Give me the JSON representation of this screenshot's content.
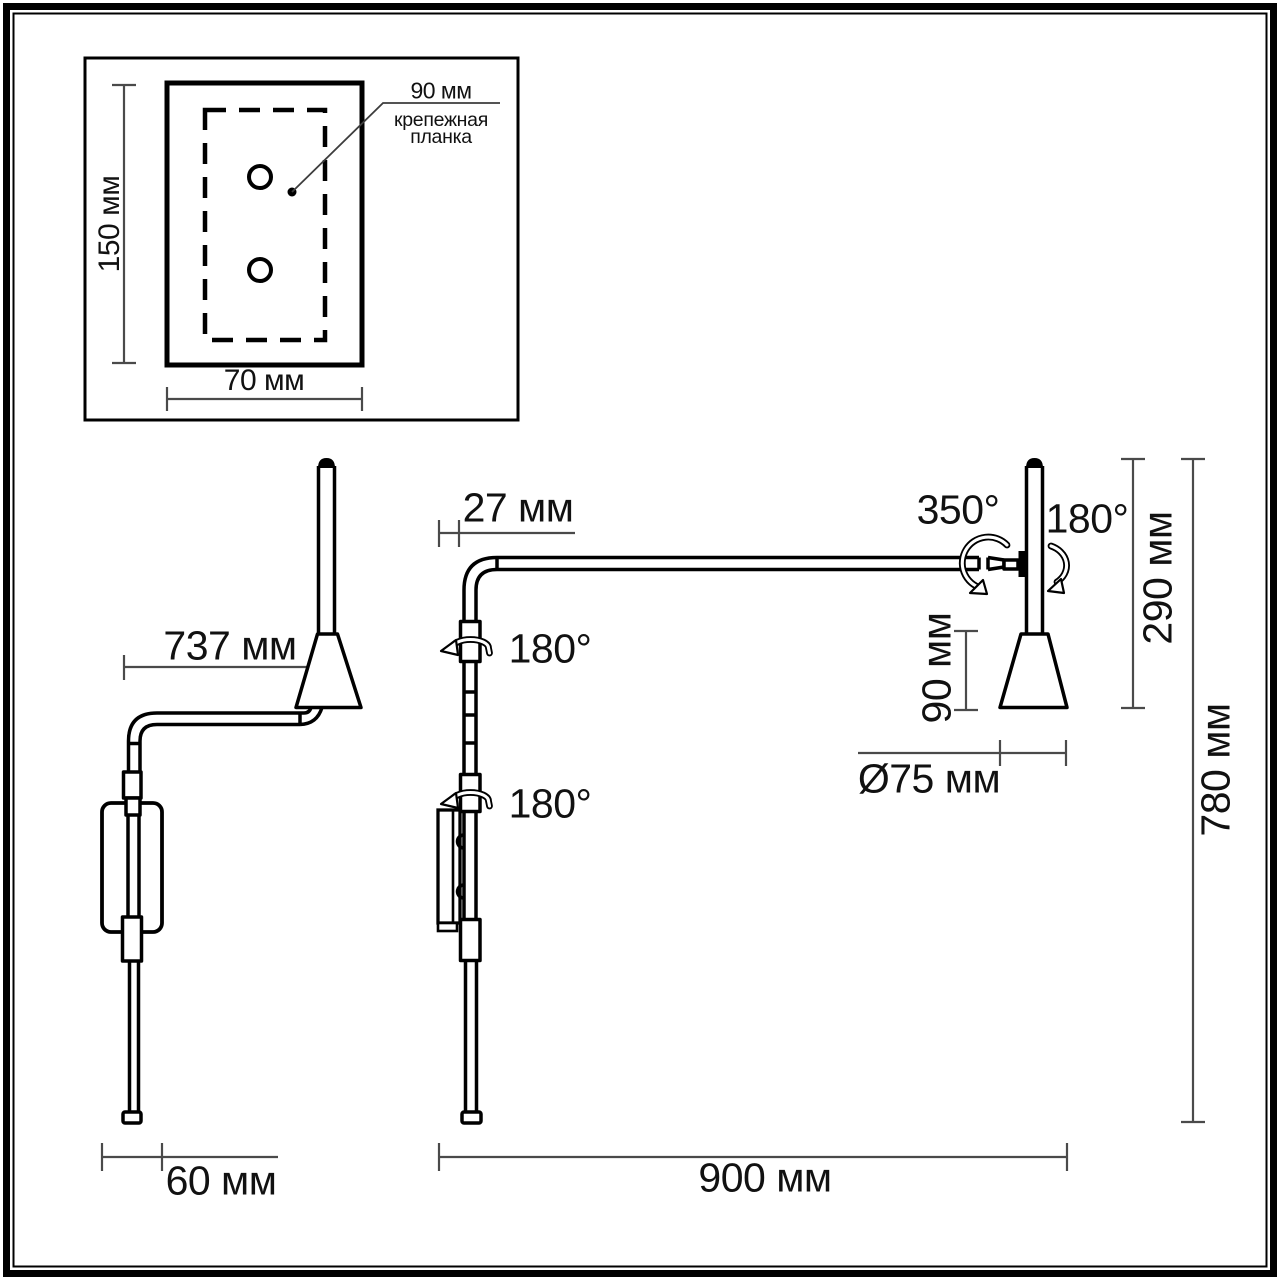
{
  "colors": {
    "background": "#ffffff",
    "outline": "#000000",
    "dimension_line": "#4a4a4a",
    "text": "#111111"
  },
  "detail_inset": {
    "height_label": "150 мм",
    "width_label": "70 мм",
    "hole_spacing_label": "90 мм",
    "caption_line1": "крепежная",
    "caption_line2": "планка"
  },
  "side_view": {
    "reach_label": "737 мм",
    "depth_label": "60 мм"
  },
  "front_view": {
    "wall_offset_label": "27 мм",
    "upper_rotation_label": "180°",
    "lower_rotation_label": "180°",
    "width_label": "900 мм"
  },
  "head_view": {
    "swivel_label": "350°",
    "tilt_label": "180°",
    "height_label": "290 мм",
    "shade_height_label": "90 мм",
    "shade_diameter_label": "Ø75 мм",
    "overall_height_label": "780 мм"
  }
}
